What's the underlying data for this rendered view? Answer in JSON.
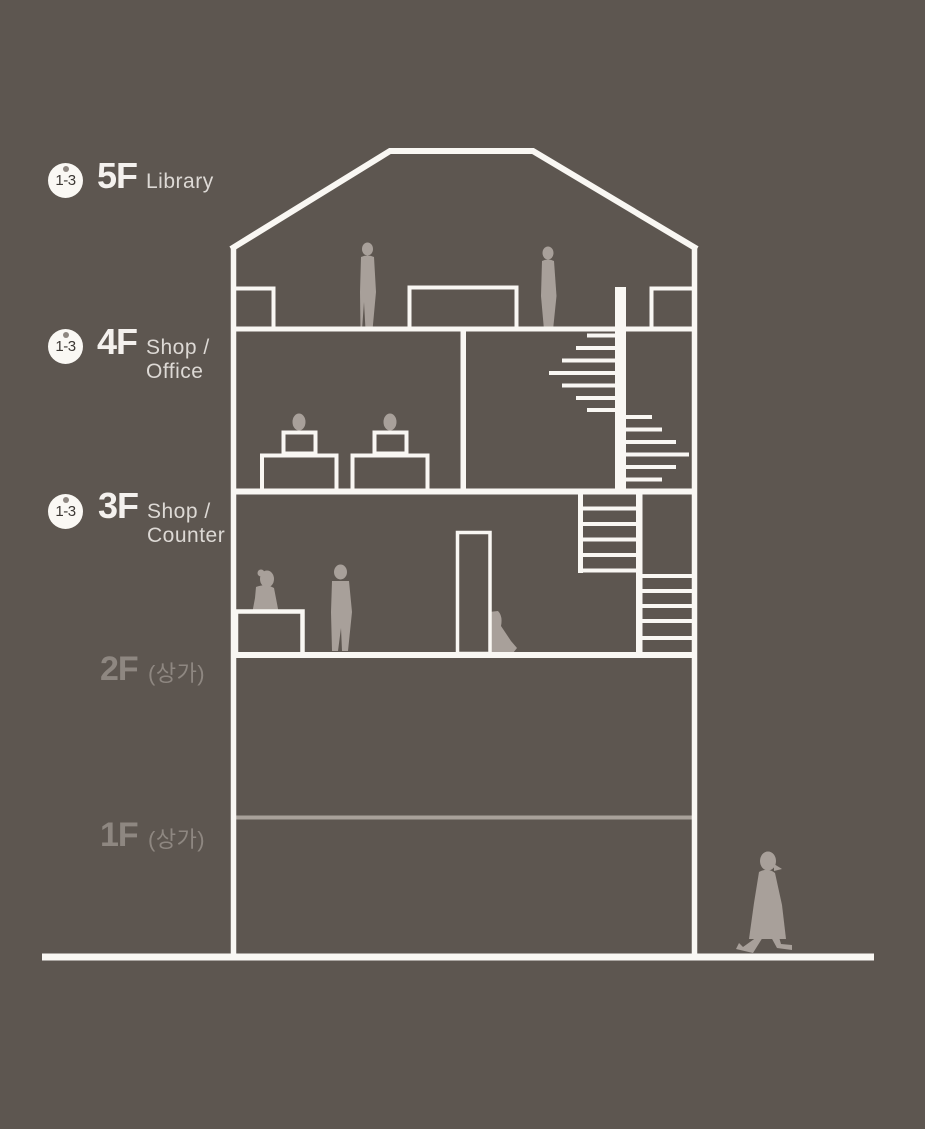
{
  "diagram": {
    "type": "building-section-diagram",
    "floors": [
      {
        "badge": "1-3",
        "name": "5F",
        "use": [
          "Library"
        ]
      },
      {
        "badge": "1-3",
        "name": "4F",
        "use": [
          "Shop /",
          "Office"
        ]
      },
      {
        "badge": "1-3",
        "name": "3F",
        "use": [
          "Shop /",
          "Counter"
        ]
      },
      {
        "badge": null,
        "name": "2F",
        "use": [
          "(상가)"
        ]
      },
      {
        "badge": null,
        "name": "1F",
        "use": [
          "(상가)"
        ]
      }
    ],
    "figures": {
      "floor5": [
        "standing-woman",
        "standing-person"
      ],
      "floor4": [
        "seated-person-at-desk",
        "seated-person-at-desk"
      ],
      "floor3": [
        "woman-sitting-on-counter",
        "standing-man",
        "person-sitting-by-door"
      ],
      "exterior": [
        "walking-woman"
      ]
    }
  },
  "palette": {
    "background": "#5d5650",
    "line_white": "#f9f7f3",
    "dim_line": "#a8a19a",
    "figure_gray": "#a8a09a",
    "bright_text": "#f4f1ee",
    "sub_text": "#ddd9d5",
    "dim_text": "#8e8781",
    "badge_bg": "#faf8f4",
    "badge_text": "#3c3834"
  }
}
